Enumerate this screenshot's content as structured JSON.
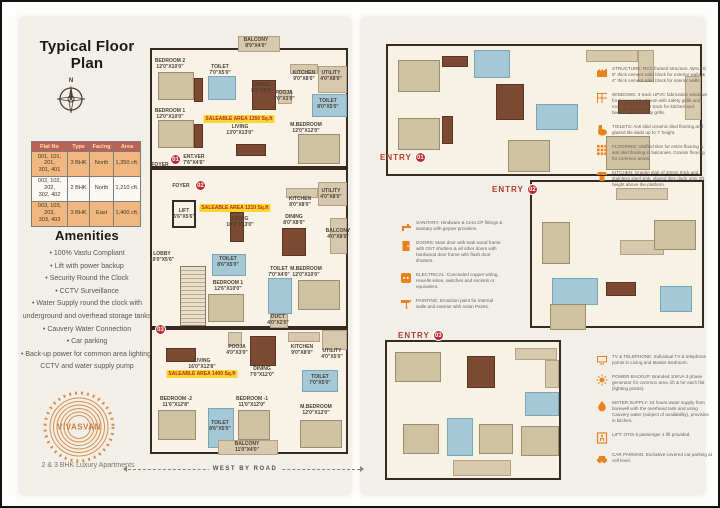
{
  "left_page": {
    "title": "Typical Floor Plan",
    "compass_north": "N",
    "flat_table": {
      "headers": [
        "Flat No",
        "Type",
        "Facing",
        "Area"
      ],
      "rows": [
        {
          "flat_no": "001, 101, 201,\n301, 401",
          "type": "3 BHK",
          "facing": "North",
          "area": "1,350 cft."
        },
        {
          "flat_no": "002, 102, 202,\n302, 402",
          "type": "2 BHK",
          "facing": "North",
          "area": "1,210 cft."
        },
        {
          "flat_no": "003, 103, 203,\n303, 403",
          "type": "3 BHK",
          "facing": "East",
          "area": "1,400 cft."
        }
      ]
    },
    "amenities": {
      "title": "Amenities",
      "items": [
        "100% Vastu Compliant",
        "Lift with power backup",
        "Security Round the Clock",
        "CCTV Surveillance",
        "Water Supply round the clock with underground and overhead storage tanks",
        "Cauvery Water Connection",
        "Car parking",
        "Back-up power for common area lighting, CCTV and water supply pump"
      ]
    },
    "logo": {
      "name": "VIVASVAN",
      "tagline": "2 & 3 BHK Luxury Apartments"
    },
    "road_label": "WEST BY ROAD"
  },
  "floor_plan": {
    "flat01": {
      "badge": "01",
      "saleable": "SALEABLE AREA 1350 Sq.ft",
      "rooms": {
        "balcony": "BALCONY\n8'9\"X4'0\"",
        "bedroom2": "BEDROOM 2\n12'0\"X10'0\"",
        "toilet1": "TOILET\n7'0\"X5'0\"",
        "dining": "DINING\n8'5\"X8'0\"",
        "kitchen": "KITCHEN\n9'0\"X8'0\"",
        "utility": "UTILITY\n4'0\"X8'0\"",
        "pooja": "POOJA\n4'0\"X3'0\"",
        "toilet2": "TOILET\n8'0\"X5'0\"",
        "mbedroom": "M.BEDROOM\n12'0\"X12'0\"",
        "bedroom1": "BEDROOM 1\n12'0\"X10'0\"",
        "living": "LIVING\n13'0\"X13'0\"",
        "foyer": "FOYER",
        "entver": "ENT.VER\n7'6\"X4'6\""
      }
    },
    "flat02": {
      "badge": "02",
      "saleable": "SALEABLE AREA 1210 Sq.ft",
      "rooms": {
        "foyer": "FOYER",
        "lift": "LIFT\n5'6\"X5'6\"",
        "living": "LIVING\n10'0\"X13'0\"",
        "kitchen": "KITCHEN\n8'0\"X8'0\"",
        "utility": "UTILITY\n4'0\"X8'0\"",
        "dining": "DINING\n8'0\"X8'0\"",
        "balcony": "BALCONY\n4'0\"X8'0\"",
        "lobby": "LOBBY\n19'0\"X5'6\"",
        "toilet1": "TOILET\n8'6\"X5'0\"",
        "mbedroom": "M.BEDROOM\n12'0\"X10'0\"",
        "bedroom1": "BEDROOM 1\n12'6\"X10'0\"",
        "toilet2": "TOILET\n7'0\"X4'0\"",
        "duct": "DUCT\n4'0\"X2'0\""
      }
    },
    "flat03": {
      "badge": "03",
      "saleable": "SALEABLE AREA 1400 Sq.ft",
      "rooms": {
        "pooja": "POOJA\n4'0\"X3'0\"",
        "living": "LIVING\n16'0\"X12'8\"",
        "dining": "DINING\n7'0\"X12'0\"",
        "kitchen": "KITCHEN\n9'0\"X8'0\"",
        "utility": "UTILITY\n4'0\"X5'0\"",
        "toilet1": "TOILET\n7'0\"X5'0\"",
        "bedroom2": "BEDROOM -2\n11'6\"X12'8\"",
        "bedroom1": "BEDROOM -1\n11'0\"X12'0\"",
        "toilet2": "TOILET\n8'6\"X5'0\"",
        "mbedroom": "M.BEDROOM\n12'0\"X12'0\"",
        "balcony": "BALCONY\n11'0\"X4'0\""
      }
    }
  },
  "right_page": {
    "title": "Specifications",
    "entries": [
      {
        "label": "ENTRY",
        "number": "01"
      },
      {
        "label": "ENTRY",
        "number": "02"
      },
      {
        "label": "ENTRY",
        "number": "03"
      }
    ],
    "spec_construction": [
      {
        "icon": "structure-icon",
        "text": "STRUCTURE: RCC framed structure. WALLS: 6\" thick cement solid block for exterior walls & 4\" thick cement solid block for interior walls."
      },
      {
        "icon": "windows-icon",
        "text": "WINDOWS: 3 track UPVC fabrication windows for living and bedroom with safety grills and mosquito mesh & 2 track for kitchen and bedroom with safety grills."
      },
      {
        "icon": "toilets-icon",
        "text": "TOILETS: Anti skid ceramic tiled flooring and glazed tile dado up to 7' height."
      },
      {
        "icon": "flooring-icon",
        "text": "FLOORING: Vitrified tiles for entire flooring & anti skid flooring in balconies. Granite flooring for common areas."
      },
      {
        "icon": "kitchen-icon",
        "text": "KITCHEN: Granite slab of 20mm thick and stainless steel sink, glazed tiles dado upto 2ft. height above the platform."
      }
    ],
    "spec_fittings": [
      {
        "icon": "sanitary-icon",
        "text": "SANITARY: Hindware & Cera CP fittings & sanitary with geyser provision."
      },
      {
        "icon": "doors-icon",
        "text": "DOORS: Main door with teak wood frame with OST shutters & all other doors with hardwood door frame with flush door shutters."
      },
      {
        "icon": "electrical-icon",
        "text": "ELECTRICAL: Concealed copper wiring, Havells wires, switches and sockets or equivalent."
      },
      {
        "icon": "painting-icon",
        "text": "PAINTING: Emulsion paint for internal walls and exterior with Asian Paints."
      }
    ],
    "spec_services": [
      {
        "icon": "tv-telephone-icon",
        "text": "TV & TELEPHONE: Individual TV & telephone points in Living and Master Bedroom."
      },
      {
        "icon": "power-backup-icon",
        "text": "POWER BACKUP: Branded 10KVA 3 phase generator for common area, lift & for each flat (lighting points)."
      },
      {
        "icon": "water-supply-icon",
        "text": "WATER SUPPLY: 24 hours water supply from borewell with the overhead tank and using Cauvery water (subject of availability), provision in kitchen."
      },
      {
        "icon": "lift-icon",
        "text": "LIFT: OTIS 6 passenger 1 lift provided."
      },
      {
        "icon": "car-parking-icon",
        "text": "CAR PARKING: Exclusive covered car parking at cell level."
      }
    ]
  },
  "colors": {
    "accent_orange": "#E8821E",
    "badge_red": "#C0272D",
    "saleable_yellow": "#F8D72E",
    "table_header": "#BD6154",
    "table_row_orange": "#F0B87E",
    "toilet_blue": "#A4C8D6",
    "wall_dark": "#372B21",
    "page_cream": "#F2EFE8"
  }
}
